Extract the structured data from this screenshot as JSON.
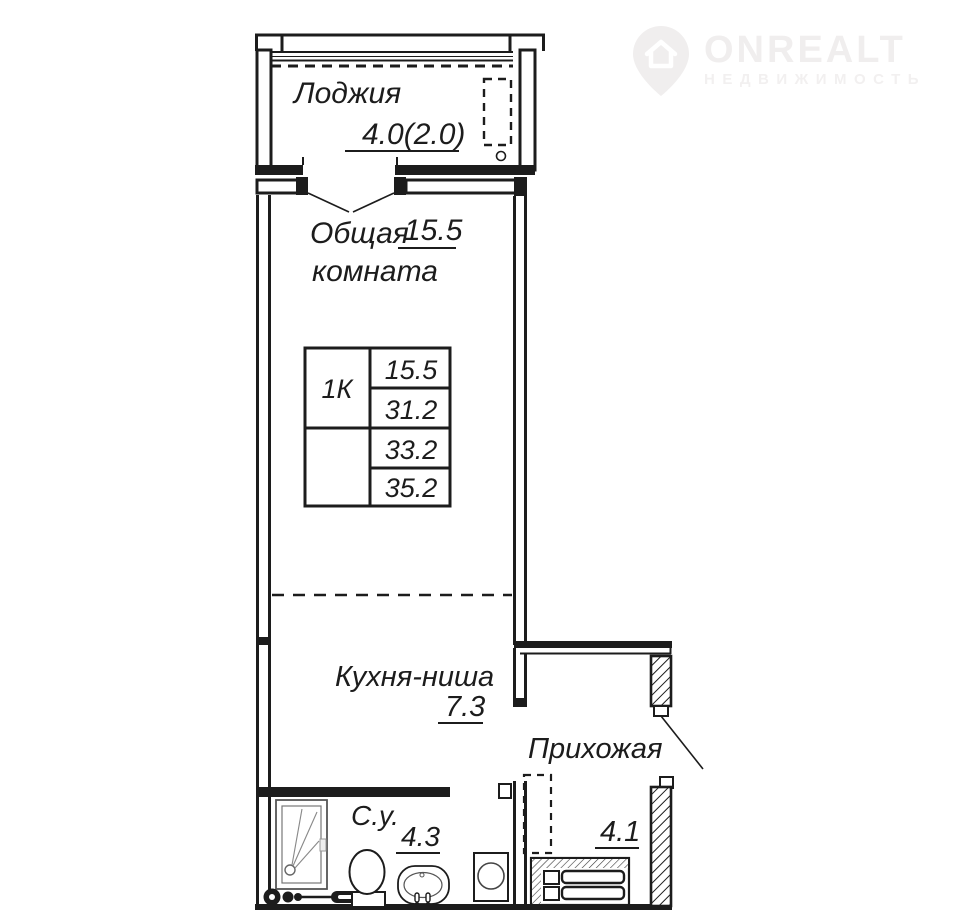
{
  "watermark": {
    "brand": "ONREALT",
    "subtitle": "НЕДВИЖИМОСТЬ"
  },
  "plan": {
    "loggia_label": "Лоджия",
    "loggia_area": "4.0(2.0)",
    "living_label_1": "Общая",
    "living_label_2": "комната",
    "living_area": "15.5",
    "kitchen_label": "Кухня-ниша",
    "kitchen_area": "7.3",
    "hallway_label": "Прихожая",
    "hallway_area": "4.1",
    "bathroom_label": "С.у.",
    "bathroom_area": "4.3"
  },
  "info_table": {
    "apartment_type": "1К",
    "rows": [
      "15.5",
      "31.2",
      "33.2",
      "35.2"
    ]
  },
  "colors": {
    "line": "#1c1c1c",
    "watermark": "#f0eeee"
  }
}
